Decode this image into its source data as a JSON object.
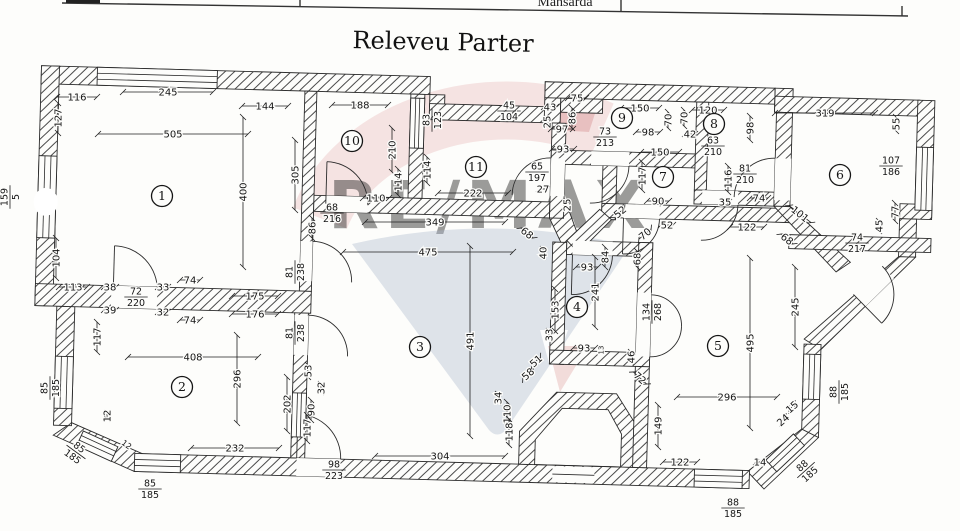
{
  "document": {
    "title": "Releveu Parter",
    "table_header_fragment": "Mansarda"
  },
  "watermark": {
    "brand": "RE/MAX",
    "pink": "#ecc3c3",
    "red": "#dc9d9d",
    "blue_gray": "#aab7cd",
    "light_blue": "#cdd6e7"
  },
  "rooms": [
    {
      "n": "1",
      "x": 162,
      "y": 196
    },
    {
      "n": "2",
      "x": 182,
      "y": 387
    },
    {
      "n": "3",
      "x": 420,
      "y": 347
    },
    {
      "n": "4",
      "x": 577,
      "y": 307
    },
    {
      "n": "5",
      "x": 718,
      "y": 346
    },
    {
      "n": "6",
      "x": 840,
      "y": 175
    },
    {
      "n": "7",
      "x": 663,
      "y": 177
    },
    {
      "n": "8",
      "x": 714,
      "y": 124
    },
    {
      "n": "9",
      "x": 622,
      "y": 118
    },
    {
      "n": "10",
      "x": 352,
      "y": 141
    },
    {
      "n": "11",
      "x": 476,
      "y": 167
    }
  ],
  "dims": [
    {
      "t": "116",
      "x": 77,
      "y": 97,
      "l": 40
    },
    {
      "t": "245",
      "x": 168,
      "y": 92,
      "l": 90
    },
    {
      "t": "144",
      "x": 265,
      "y": 106,
      "l": 46
    },
    {
      "t": "188",
      "x": 360,
      "y": 105,
      "l": 56
    },
    {
      "t": "505",
      "x": 173,
      "y": 134,
      "l": 150
    },
    {
      "t": "127",
      "x": 58,
      "y": 118,
      "r": -90,
      "l": 30
    },
    {
      "t": "159/5",
      "x": 10,
      "y": 197,
      "r": -90
    },
    {
      "t": "104",
      "x": 56,
      "y": 258,
      "r": -90,
      "l": 40
    },
    {
      "t": "400",
      "x": 243,
      "y": 192,
      "r": -90,
      "l": 150
    },
    {
      "t": "305",
      "x": 295,
      "y": 175,
      "r": -90,
      "l": 70
    },
    {
      "t": "113",
      "x": 73,
      "y": 287,
      "l": 28
    },
    {
      "t": "38",
      "x": 110,
      "y": 287,
      "l": 12
    },
    {
      "t": "72/220",
      "x": 136,
      "y": 297
    },
    {
      "t": "33",
      "x": 163,
      "y": 287,
      "l": 10
    },
    {
      "t": "74",
      "x": 190,
      "y": 280,
      "l": 20
    },
    {
      "t": "39",
      "x": 110,
      "y": 310,
      "l": 12
    },
    {
      "t": "32",
      "x": 163,
      "y": 312,
      "l": 10
    },
    {
      "t": "74",
      "x": 190,
      "y": 320,
      "l": 20
    },
    {
      "t": "175",
      "x": 255,
      "y": 296,
      "l": 46
    },
    {
      "t": "176",
      "x": 255,
      "y": 314,
      "l": 46
    },
    {
      "t": "117",
      "x": 97,
      "y": 337,
      "r": -90,
      "l": 30
    },
    {
      "t": "210",
      "x": 392,
      "y": 150,
      "r": -90,
      "l": 44
    },
    {
      "t": "114",
      "x": 398,
      "y": 182,
      "r": -90,
      "l": 26
    },
    {
      "t": "114",
      "x": 427,
      "y": 170,
      "r": -90,
      "l": 26
    },
    {
      "t": "83/123",
      "x": 432,
      "y": 120,
      "r": -90
    },
    {
      "t": "110",
      "x": 376,
      "y": 198,
      "l": 26
    },
    {
      "t": "68/216",
      "x": 332,
      "y": 213
    },
    {
      "t": "86",
      "x": 312,
      "y": 228,
      "r": -90,
      "l": 20
    },
    {
      "t": "349",
      "x": 435,
      "y": 222,
      "l": 140
    },
    {
      "t": "475",
      "x": 428,
      "y": 252,
      "l": 170
    },
    {
      "t": "222",
      "x": 473,
      "y": 193,
      "l": 70
    },
    {
      "t": "65/197",
      "x": 537,
      "y": 172
    },
    {
      "t": "27",
      "x": 543,
      "y": 189,
      "l": 8
    },
    {
      "t": "45/104",
      "x": 509,
      "y": 111
    },
    {
      "t": "43",
      "x": 550,
      "y": 107,
      "l": 12
    },
    {
      "t": "75",
      "x": 577,
      "y": 98,
      "l": 18
    },
    {
      "t": "25",
      "x": 547,
      "y": 122,
      "r": -90,
      "l": 8
    },
    {
      "t": "86",
      "x": 572,
      "y": 118,
      "r": -90,
      "l": 20
    },
    {
      "t": "97",
      "x": 562,
      "y": 129,
      "l": 22
    },
    {
      "t": "93",
      "x": 563,
      "y": 149,
      "l": 22
    },
    {
      "t": "25",
      "x": 567,
      "y": 205,
      "r": -90,
      "l": 8
    },
    {
      "t": "73/213",
      "x": 605,
      "y": 137
    },
    {
      "t": "150",
      "x": 640,
      "y": 108,
      "l": 38
    },
    {
      "t": "98",
      "x": 648,
      "y": 132,
      "l": 24
    },
    {
      "t": "70",
      "x": 668,
      "y": 120,
      "r": -90,
      "l": 16
    },
    {
      "t": "70",
      "x": 684,
      "y": 118,
      "r": -90,
      "l": 16
    },
    {
      "t": "42",
      "x": 690,
      "y": 134,
      "l": 10
    },
    {
      "t": "120",
      "x": 708,
      "y": 110,
      "l": 32
    },
    {
      "t": "63/210",
      "x": 713,
      "y": 146
    },
    {
      "t": "98",
      "x": 750,
      "y": 128,
      "r": -90,
      "l": 24
    },
    {
      "t": "150",
      "x": 660,
      "y": 152,
      "l": 38
    },
    {
      "t": "117",
      "x": 642,
      "y": 176,
      "r": -90,
      "l": 28
    },
    {
      "t": "90",
      "x": 658,
      "y": 201,
      "l": 22
    },
    {
      "t": "81/210",
      "x": 745,
      "y": 174
    },
    {
      "t": "116",
      "x": 728,
      "y": 179,
      "r": -90,
      "l": 26
    },
    {
      "t": "35",
      "x": 725,
      "y": 202,
      "l": 8
    },
    {
      "t": "74",
      "x": 759,
      "y": 198,
      "l": 18
    },
    {
      "t": "319",
      "x": 825,
      "y": 113,
      "l": 100
    },
    {
      "t": "55",
      "x": 896,
      "y": 124,
      "r": -90,
      "l": 14
    },
    {
      "t": "107/186",
      "x": 891,
      "y": 166
    },
    {
      "t": "77",
      "x": 895,
      "y": 212,
      "r": -90,
      "l": 18
    },
    {
      "t": "45",
      "x": 879,
      "y": 226,
      "r": -90,
      "l": 10
    },
    {
      "t": "52",
      "x": 620,
      "y": 212,
      "r": -40,
      "l": 12
    },
    {
      "t": "52",
      "x": 667,
      "y": 225,
      "l": 12
    },
    {
      "t": "70",
      "x": 645,
      "y": 234,
      "r": -40,
      "l": 16
    },
    {
      "t": "101",
      "x": 800,
      "y": 214,
      "r": 38,
      "l": 28
    },
    {
      "t": "122",
      "x": 747,
      "y": 227,
      "l": 34
    },
    {
      "t": "68",
      "x": 787,
      "y": 239,
      "r": 38,
      "l": 16
    },
    {
      "t": "74/217",
      "x": 857,
      "y": 243
    },
    {
      "t": "245",
      "x": 795,
      "y": 307,
      "r": -90,
      "l": 80
    },
    {
      "t": "68",
      "x": 637,
      "y": 259,
      "r": -90,
      "l": 16
    },
    {
      "t": "84",
      "x": 605,
      "y": 257,
      "r": -90,
      "l": 20
    },
    {
      "t": "93",
      "x": 587,
      "y": 267,
      "l": 22
    },
    {
      "t": "40",
      "x": 543,
      "y": 253,
      "r": -90,
      "l": 8
    },
    {
      "t": "68",
      "x": 527,
      "y": 233,
      "r": 38,
      "l": 16
    },
    {
      "t": "241",
      "x": 595,
      "y": 292,
      "r": -90,
      "l": 70
    },
    {
      "t": "153",
      "x": 555,
      "y": 310,
      "r": -90,
      "l": 42
    },
    {
      "t": "134/268",
      "x": 652,
      "y": 312,
      "r": -90
    },
    {
      "t": "33",
      "x": 549,
      "y": 335,
      "r": -90,
      "l": 8
    },
    {
      "t": "93",
      "x": 584,
      "y": 348,
      "l": 22
    },
    {
      "t": "13",
      "x": 600,
      "y": 350,
      "r": -90,
      "s": 7
    },
    {
      "t": "34",
      "x": 498,
      "y": 398,
      "r": -90,
      "l": 8
    },
    {
      "t": "110",
      "x": 507,
      "y": 414,
      "r": -90,
      "l": 24
    },
    {
      "t": "118",
      "x": 509,
      "y": 432,
      "r": -90,
      "l": 26
    },
    {
      "t": "58",
      "x": 528,
      "y": 374,
      "r": -42,
      "l": 14
    },
    {
      "t": "51",
      "x": 536,
      "y": 361,
      "r": -42,
      "l": 12
    },
    {
      "t": "46",
      "x": 631,
      "y": 357,
      "r": -90,
      "l": 10
    },
    {
      "t": "72",
      "x": 640,
      "y": 378,
      "r": 42,
      "l": 18
    },
    {
      "t": "491",
      "x": 470,
      "y": 341,
      "r": -90,
      "l": 190
    },
    {
      "t": "304",
      "x": 440,
      "y": 456,
      "l": 130
    },
    {
      "t": "98/223",
      "x": 334,
      "y": 470
    },
    {
      "t": "81/238",
      "x": 295,
      "y": 272,
      "r": -90
    },
    {
      "t": "81/238",
      "x": 295,
      "y": 333,
      "r": -90
    },
    {
      "t": "408",
      "x": 193,
      "y": 357,
      "l": 130
    },
    {
      "t": "296",
      "x": 237,
      "y": 379,
      "r": -90,
      "l": 88
    },
    {
      "t": "232",
      "x": 235,
      "y": 448,
      "l": 88
    },
    {
      "t": "85/185",
      "x": 50,
      "y": 388,
      "r": -90
    },
    {
      "t": "12",
      "x": 107,
      "y": 416,
      "r": -90,
      "l": 6
    },
    {
      "t": "85/185",
      "x": 76,
      "y": 452,
      "r": 36
    },
    {
      "t": "12",
      "x": 127,
      "y": 444,
      "r": 36,
      "s": 8
    },
    {
      "t": "85/185",
      "x": 150,
      "y": 489
    },
    {
      "t": "53",
      "x": 308,
      "y": 371,
      "r": -90,
      "l": 12
    },
    {
      "t": "32",
      "x": 321,
      "y": 388,
      "r": -90,
      "l": 8
    },
    {
      "t": "202",
      "x": 287,
      "y": 404,
      "r": -90,
      "l": 54
    },
    {
      "t": "90",
      "x": 311,
      "y": 410,
      "r": -90,
      "l": 20
    },
    {
      "t": "117",
      "x": 307,
      "y": 428,
      "r": -90,
      "l": 26
    },
    {
      "t": "495",
      "x": 750,
      "y": 343,
      "r": -90,
      "l": 170
    },
    {
      "t": "296",
      "x": 727,
      "y": 397,
      "l": 100
    },
    {
      "t": "149",
      "x": 658,
      "y": 426,
      "r": -90,
      "l": 42
    },
    {
      "t": "122",
      "x": 680,
      "y": 462,
      "l": 34
    },
    {
      "t": "14",
      "x": 760,
      "y": 462,
      "l": 8
    },
    {
      "t": "24",
      "x": 783,
      "y": 420,
      "r": -42,
      "l": 8
    },
    {
      "t": "15",
      "x": 792,
      "y": 407,
      "r": -42,
      "l": 8
    },
    {
      "t": "88/185",
      "x": 839,
      "y": 392,
      "r": -90
    },
    {
      "t": "88/185",
      "x": 806,
      "y": 470,
      "r": -42
    },
    {
      "t": "88/185",
      "x": 733,
      "y": 508
    }
  ]
}
